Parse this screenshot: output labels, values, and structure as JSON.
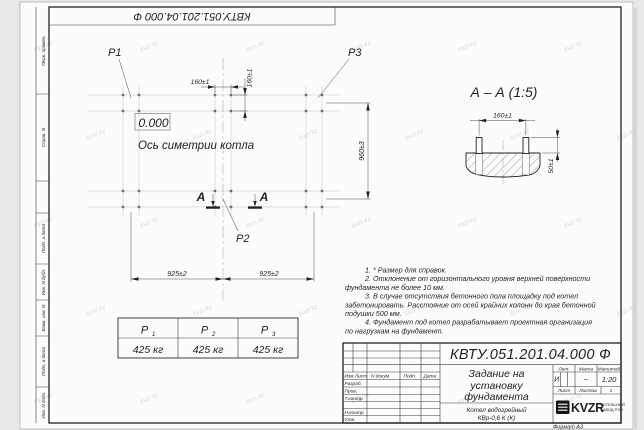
{
  "sheet": {
    "designation": "КВТУ.051.201.04.000  Ф",
    "format_note": "Формат А3",
    "watermark": "kvzr.kz"
  },
  "frame_labels": {
    "perv_primen": "Перв. примен.",
    "sprav_n": "Справ. N",
    "podp_data_1": "Подп. и дата",
    "inv_dubl": "Инв. N дубл.",
    "vzam_inv": "Взам. инв. N",
    "podp_data_2": "Подп. и дата",
    "inv_podl": "Инв. N подл."
  },
  "plan": {
    "label_p1": "Р1",
    "label_p2": "Р2",
    "label_p3": "Р3",
    "elevation": "0.000",
    "axis_caption": "Ось симетрии котла",
    "dim_bolt_x": "160±1",
    "dim_bolt_y": "160±1",
    "dim_span_left": "925±2",
    "dim_span_right": "925±2",
    "dim_depth": "960±3",
    "section_letter_left": "А",
    "section_letter_right": "А"
  },
  "section": {
    "title": "А – А (1:5)",
    "dim_bolt_spacing": "160±1",
    "dim_bolt_height": "50±1"
  },
  "notes_lines": [
    "1.  * Размер для справок.",
    "2.  Отклонение от горизонтального уровня верхней поверхности",
    "фундамента не более 10 мм.",
    "3.  В случае отсутствия бетонного пола площадку под котел",
    "забетонировать. Расстояние от осей крайних колонн до края бетонной",
    "подушки 500 мм.",
    "4.  Фундамент под котел разрабатывает проектная организация",
    "по нагрузкам на фундамент."
  ],
  "load_table": {
    "columns": [
      {
        "sym": "Р",
        "sub": "1",
        "value": "425 кг"
      },
      {
        "sym": "Р",
        "sub": "2",
        "value": "425 кг"
      },
      {
        "sym": "Р",
        "sub": "3",
        "value": "425 кг"
      }
    ]
  },
  "title_block": {
    "designation": "КВТУ.051.201.04.000  Ф",
    "doc_title_line1": "Задание на",
    "doc_title_line2": "установку",
    "doc_title_line3": "фундамента",
    "rev_header": {
      "izm_list": "Изм.Лист",
      "n_dokum": "N докум.",
      "podp": "Подп.",
      "data": "Дата"
    },
    "row_razrab": "Разраб.",
    "row_prov": "Пров.",
    "row_tkontr": "Т.контр.",
    "row_nkontr": "Н.контр.",
    "row_utv": "Утв.",
    "lit_label": "Лит.",
    "lit_value": "И",
    "mass_label": "Масса",
    "mass_value": "–",
    "scale_label": "Масштаб",
    "scale_value": "1:20",
    "sheet_label": "Лист",
    "sheets_label": "Листов",
    "sheets_value": "1",
    "product_line1": "Котел водогрейный",
    "product_line2": "КВр-0,6  К  (К)",
    "logo_text": "KVZR",
    "company_line1": "КОТЕЛЬНЫЙ",
    "company_line2": "ЗАВОД РЭП"
  }
}
